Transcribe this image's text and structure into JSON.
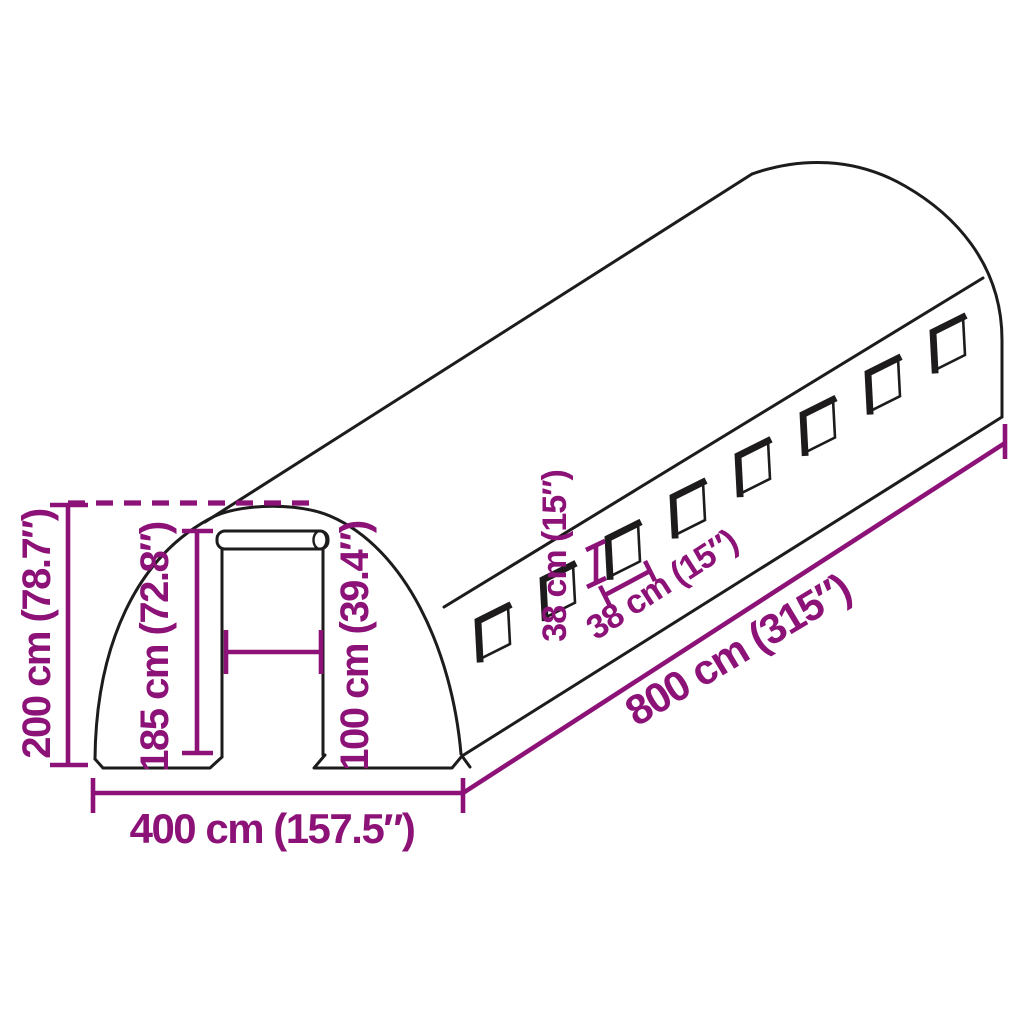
{
  "diagram": {
    "description": "Dimension line drawing of an arched polytunnel greenhouse with a roll-up door and side windows",
    "window_count": 8,
    "colors": {
      "background": "#ffffff",
      "outline": "#1d1b1c",
      "dimension": "#8c1278"
    },
    "labels": {
      "total_height": "200 cm (78.7″)",
      "door_height": "185 cm (72.8″)",
      "door_width": "100 cm (39.4″)",
      "base_width": "400 cm (157.5″)",
      "length": "800 cm (315″)",
      "window_height": "38 cm (15″)",
      "window_width": "38 cm (15″)"
    }
  }
}
